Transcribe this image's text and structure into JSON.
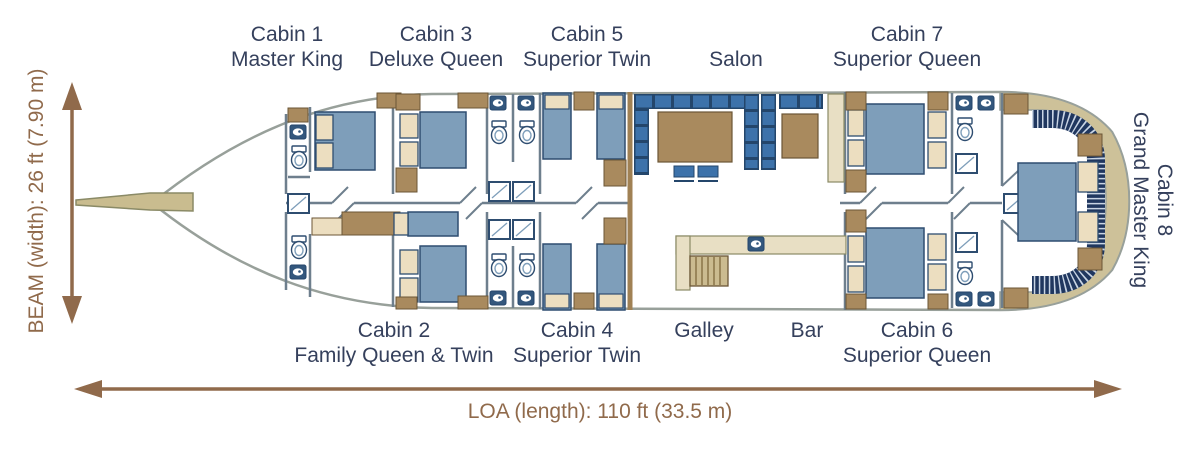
{
  "plan": {
    "rooms_top": [
      {
        "name": "Cabin 1",
        "desc": "Master King"
      },
      {
        "name": "Cabin 3",
        "desc": "Deluxe Queen"
      },
      {
        "name": "Cabin 5",
        "desc": "Superior Twin"
      },
      {
        "name": "Salon",
        "desc": ""
      },
      {
        "name": "Cabin 7",
        "desc": "Superior Queen"
      }
    ],
    "rooms_bottom": [
      {
        "name": "Cabin 2",
        "desc": "Family Queen & Twin"
      },
      {
        "name": "Cabin 4",
        "desc": "Superior Twin"
      },
      {
        "name": "Galley",
        "desc": ""
      },
      {
        "name": "Bar",
        "desc": ""
      },
      {
        "name": "Cabin 6",
        "desc": "Superior Queen"
      }
    ],
    "room_stern": {
      "name": "Cabin 8",
      "desc": "Grand Master King"
    },
    "dimensions": {
      "beam": "BEAM (width): 26 ft (7.90 m)",
      "loa": "LOA (length): 110 ft (33.5 m)"
    },
    "colors": {
      "label_text": "#35405c",
      "dimension_text": "#906a4b",
      "bed_blue": "#7e9eba",
      "salon_bench_blue": "#3d72aa",
      "stern_sofa_navy": "#20375f",
      "wood_tan": "#a98a5e",
      "cream": "#ecdec0",
      "stern_deck_tan": "#cdc199",
      "hull_outline": "#98a09a"
    }
  }
}
